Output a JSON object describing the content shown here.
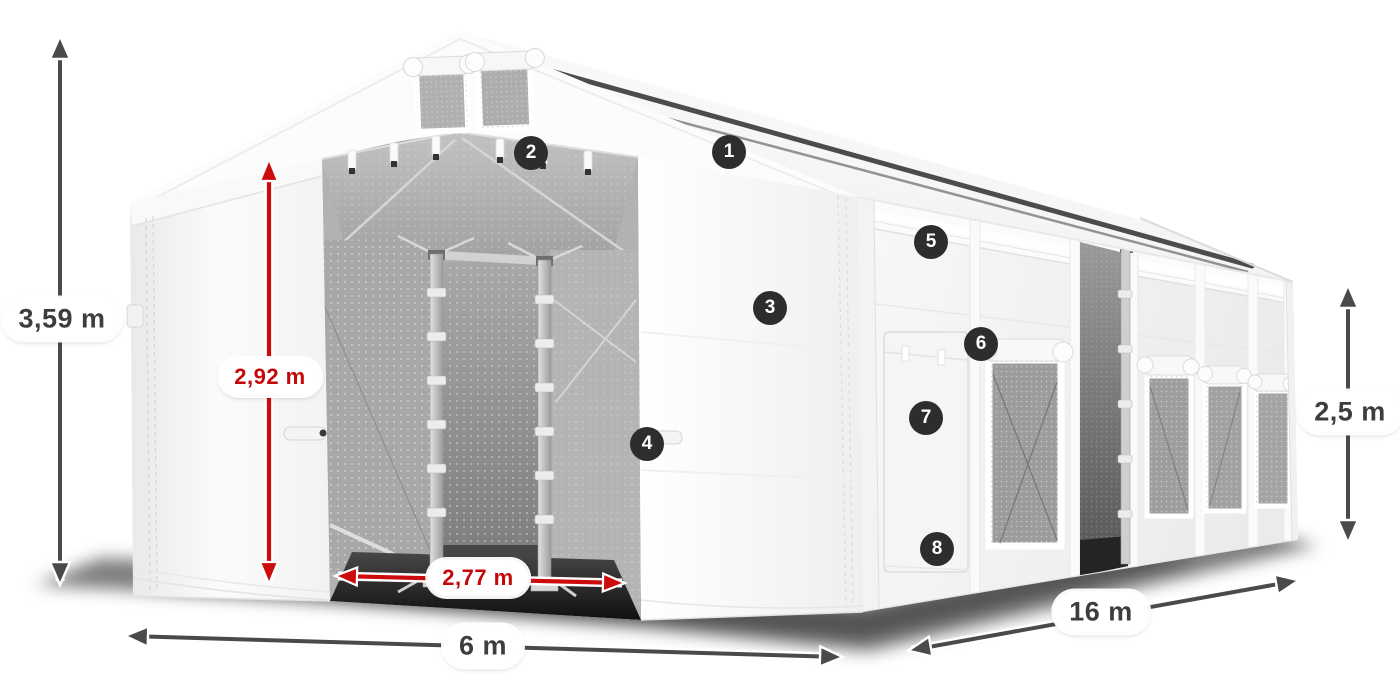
{
  "diagram": {
    "subject": "storage-tent-dimension-diagram",
    "dimensions": {
      "total_height": "3,59 m",
      "clearance_height": "2,92 m",
      "entrance_width": "2,77 m",
      "front_width": "6 m",
      "side_length": "16 m",
      "side_height": "2,5 m"
    },
    "callouts": [
      "1",
      "2",
      "3",
      "4",
      "5",
      "6",
      "7",
      "8"
    ],
    "colors": {
      "dimension_primary": "#4a4a4a",
      "dimension_accent": "#cc0c0c",
      "label_text_dark": "#3d3d3d",
      "label_text_red": "#c50909",
      "label_background": "#ffffff",
      "callout_background": "#2d2d2d",
      "callout_text": "#ffffff",
      "tent_fabric": "#f7f7f7",
      "canvas_background": "#ffffff"
    }
  }
}
